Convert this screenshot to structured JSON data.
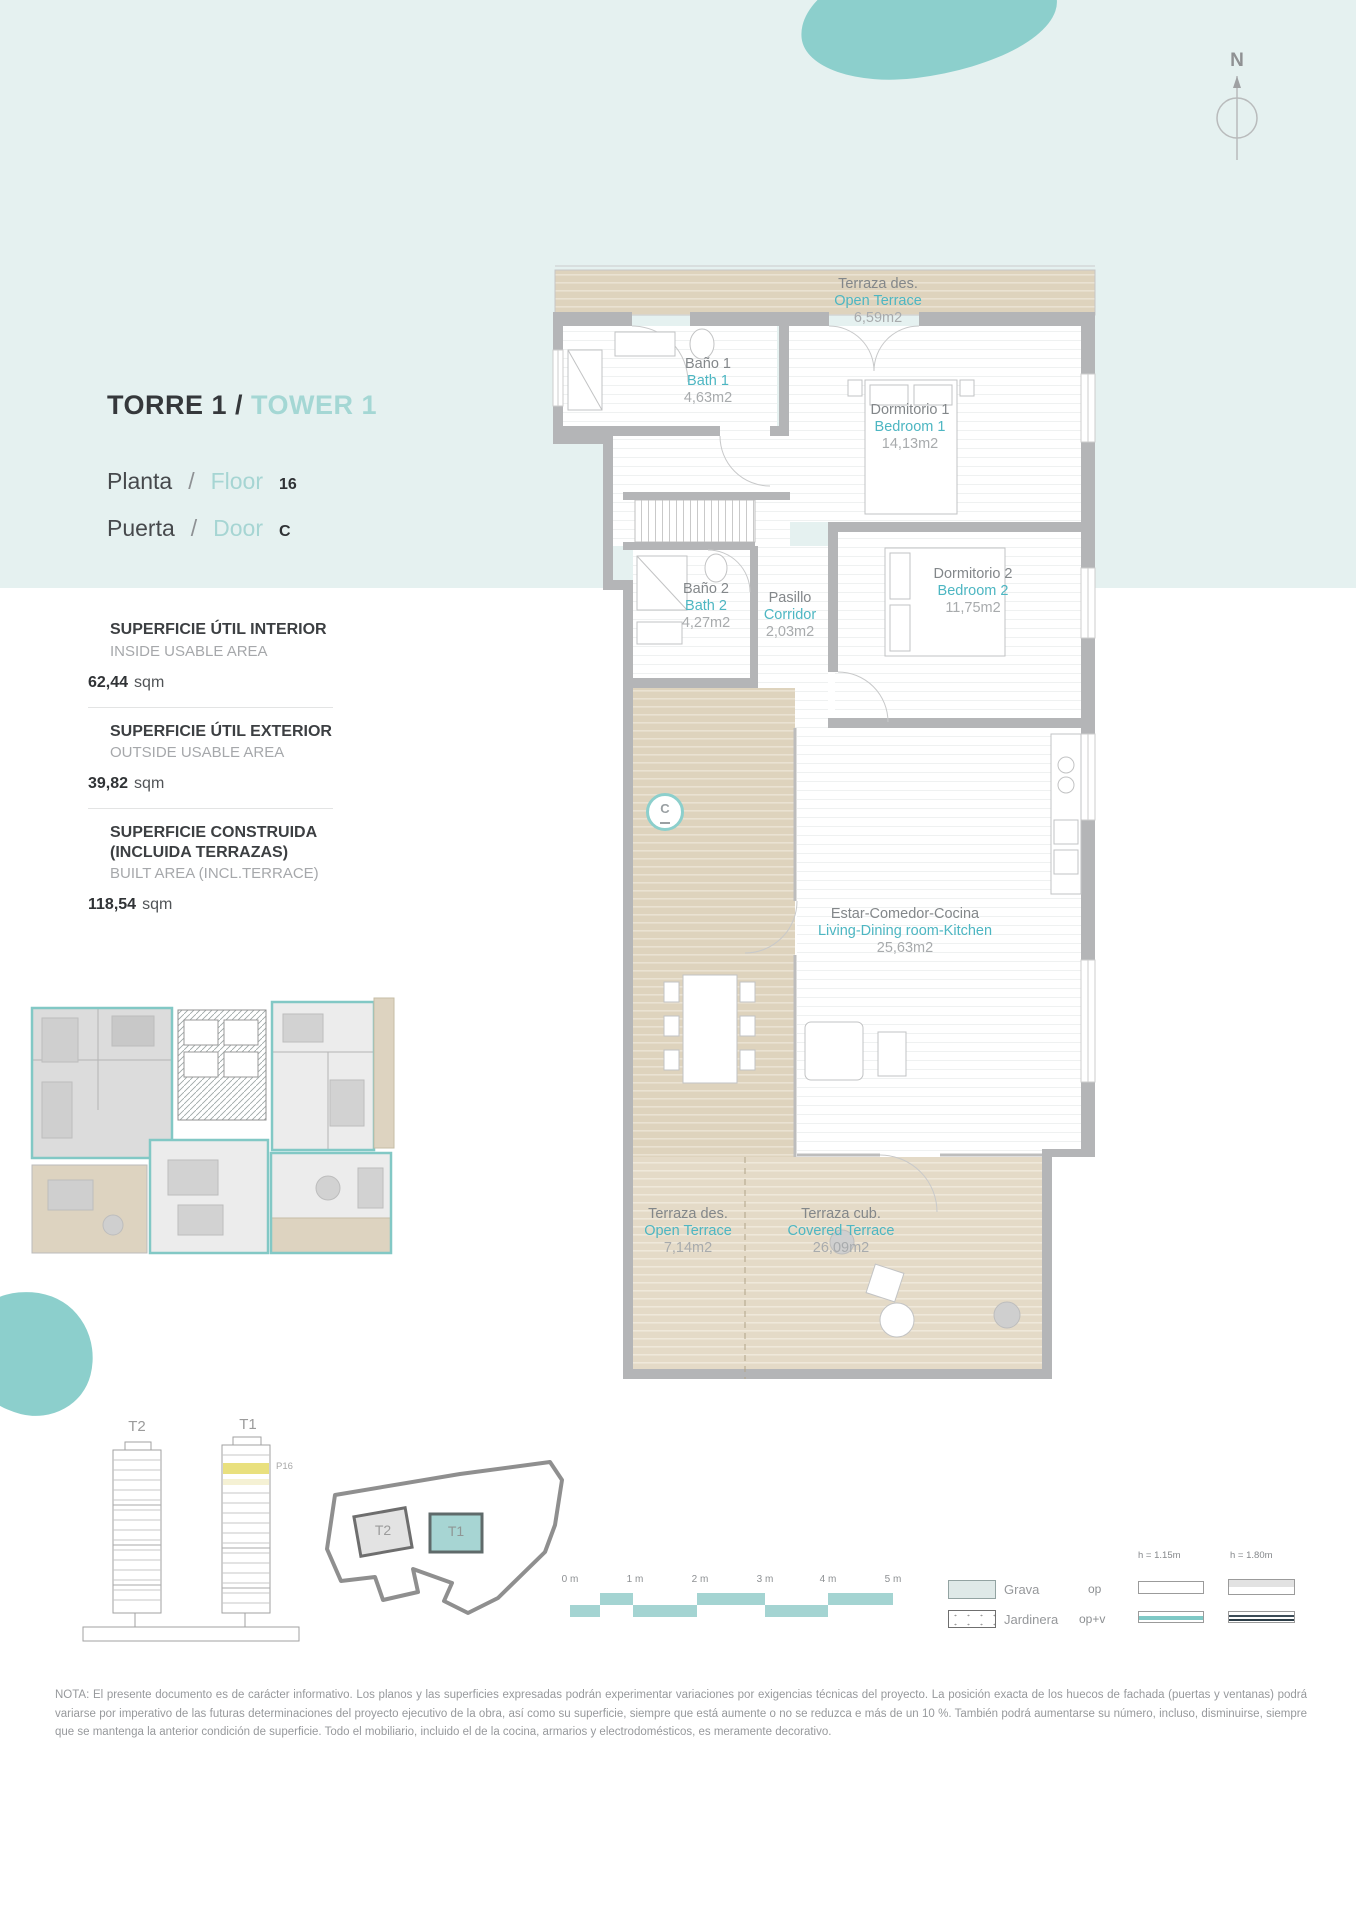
{
  "colors": {
    "accent_teal": "#4db6c2",
    "header_teal": "#a4d7d4",
    "band_teal": "#e5f1f0",
    "blob_teal": "#8ccfcc",
    "terrace_beige": "#ded3bd",
    "wall_gray": "#b4b5b7",
    "floor_highlight_yellow": "#e9e07e"
  },
  "header": {
    "title_es": "TORRE 1",
    "title_slash": "/",
    "title_en": "TOWER 1",
    "floor": {
      "es": "Planta",
      "slash": "/",
      "en": "Floor",
      "value": "16"
    },
    "door": {
      "es": "Puerta",
      "slash": "/",
      "en": "Door",
      "value": "C"
    }
  },
  "areas": [
    {
      "title_es": "SUPERFICIE ÚTIL INTERIOR",
      "title_en": "INSIDE USABLE AREA",
      "value": "62,44",
      "unit": "sqm"
    },
    {
      "title_es": "SUPERFICIE ÚTIL EXTERIOR",
      "title_en": "OUTSIDE USABLE AREA",
      "value": "39,82",
      "unit": "sqm"
    },
    {
      "title_es": "SUPERFICIE CONSTRUIDA (INCLUIDA TERRAZAS)",
      "title_en": "BUILT AREA (INCL.TERRACE)",
      "value": "118,54",
      "unit": "sqm"
    }
  ],
  "rooms": [
    {
      "es": "Terraza des.",
      "en": "Open Terrace",
      "area": "6,59m2"
    },
    {
      "es": "Baño 1",
      "en": "Bath 1",
      "area": "4,63m2"
    },
    {
      "es": "Dormitorio 1",
      "en": "Bedroom 1",
      "area": "14,13m2"
    },
    {
      "es": "Baño 2",
      "en": "Bath 2",
      "area": "4,27m2"
    },
    {
      "es": "Pasillo",
      "en": "Corridor",
      "area": "2,03m2"
    },
    {
      "es": "Dormitorio 2",
      "en": "Bedroom 2",
      "area": "11,75m2"
    },
    {
      "es": "Estar-Comedor-Cocina",
      "en": "Living-Dining room-Kitchen",
      "area": "25,63m2"
    },
    {
      "es": "Terraza des.",
      "en": "Open Terrace",
      "area": "7,14m2"
    },
    {
      "es": "Terraza cub.",
      "en": "Covered Terrace",
      "area": "26,09m2"
    }
  ],
  "door_marker": "C",
  "compass_label": "N",
  "towers": {
    "left_label": "T2",
    "right_label": "T1",
    "floor_tag": "P16"
  },
  "site_plan": {
    "t2_label": "T2",
    "t1_label": "T1"
  },
  "scale_bar": {
    "labels": [
      "0 m",
      "1 m",
      "2 m",
      "3 m",
      "4 m",
      "5 m"
    ]
  },
  "legend": {
    "grava": "Grava",
    "jardinera": "Jardinera",
    "op": "op",
    "op_v": "op+v",
    "h1": "h = 1.15m",
    "h2": "h = 1.80m"
  },
  "note": "NOTA: El presente documento es de carácter informativo. Los planos y las superficies expresadas podrán experimentar variaciones por exigencias técnicas del proyecto. La posición exacta de los huecos de fachada (puertas y ventanas) podrá variarse por imperativo de las futuras determinaciones del proyecto ejecutivo de la obra, así como su superficie, siempre que está aumente o no se reduzca e más de un 10 %. También podrá aumentarse su número, incluso, disminuirse, siempre que se mantenga la anterior condición de superficie. Todo el mobiliario, incluido el de la cocina, armarios y electrodomésticos, es meramente decorativo."
}
